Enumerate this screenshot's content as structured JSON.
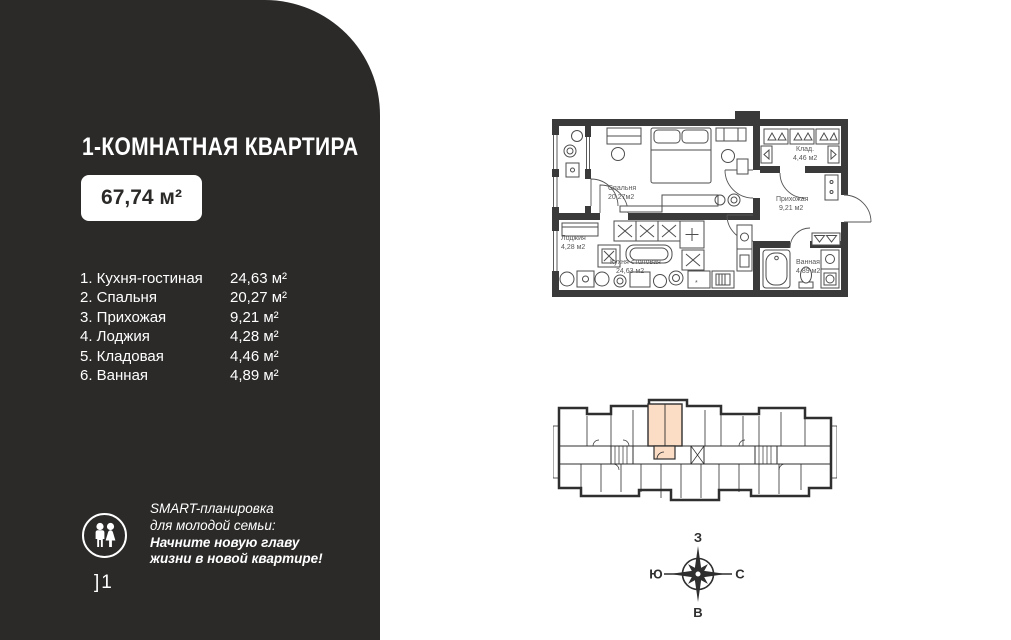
{
  "colors": {
    "panel_bg": "#2b2a29",
    "highlight": "#fbdcc4",
    "wall": "#3a3a3a"
  },
  "panel": {
    "title": "1-КОМНАТНАЯ КВАРТИРА",
    "total_area": "67,74 м²",
    "rooms": [
      {
        "label": "1. Кухня-гостиная",
        "area": "24,63 м²"
      },
      {
        "label": "2. Спальня",
        "area": "20,27 м²"
      },
      {
        "label": "3. Прихожая",
        "area": "9,21 м²"
      },
      {
        "label": "4. Лоджия",
        "area": "4,28 м²"
      },
      {
        "label": "5. Кладовая",
        "area": "4,46 м²"
      },
      {
        "label": "6. Ванная",
        "area": "4,89 м²"
      }
    ],
    "promo": {
      "line1": "SMART-планировка",
      "line2": "для молодой семьи:",
      "line3": "Начните новую главу",
      "line4": "жизни в новой квартире!"
    },
    "page_mark": "]1"
  },
  "floor_plan": {
    "loggia_name": "Лоджия",
    "loggia_area": "4,28 м2",
    "bedroom_name": "Спальня",
    "bedroom_area": "20,27м2",
    "storage_name": "Клад.",
    "storage_area": "4,46 м2",
    "hall_name": "Прихожая",
    "hall_area": "9,21 м2",
    "kitchen_name": "Кухня-столовая",
    "kitchen_area": "24,63 м2",
    "bath_name": "Ванная",
    "bath_area": "4,89 м2",
    "stove_mark": "*"
  },
  "compass": {
    "top": "З",
    "left": "Ю",
    "right": "С",
    "bottom": "В"
  }
}
